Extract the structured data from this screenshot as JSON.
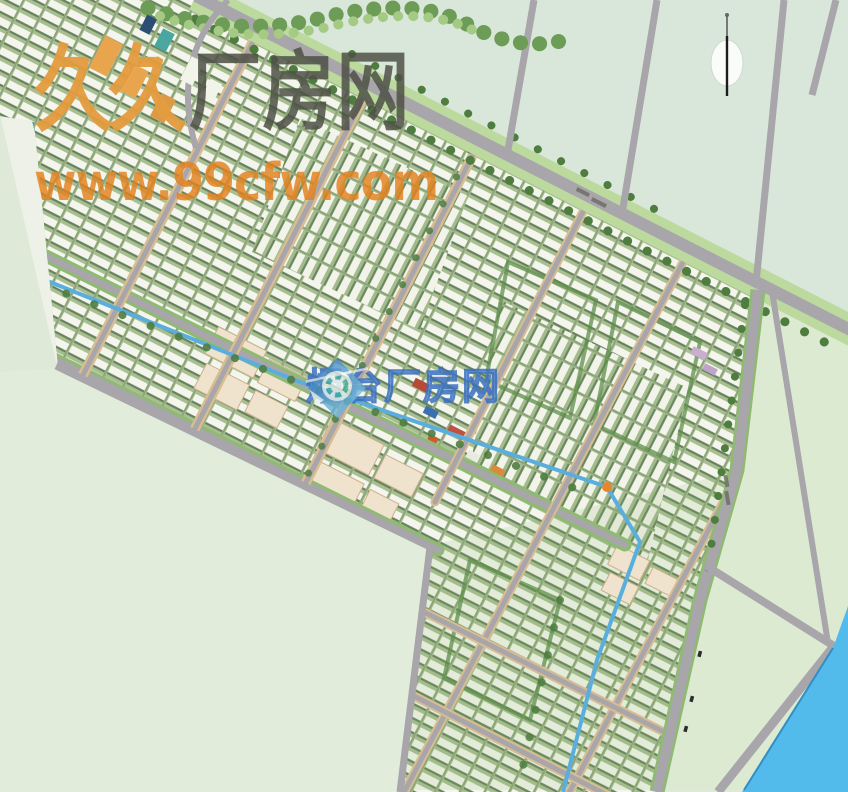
{
  "map": {
    "description": "aerial master plan rendering of an industrial park",
    "compass": {
      "icon": "north-compass-icon"
    }
  },
  "watermarks": {
    "primary": {
      "brand_cn_prefix": "久久",
      "brand_cn_suffix": "厂房网",
      "url": "www.99cfw.com",
      "prefix_color": "#e49b3e",
      "suffix_color": "#4e5146",
      "url_color": "#e4821e"
    },
    "secondary": {
      "brand_cn": "烟台厂房网",
      "color": "#3a6fc0",
      "logo": "diamond-aperture-logo-icon"
    }
  },
  "colors": {
    "land": "#dfe9d8",
    "empty_parcel": "#d9e7da",
    "road": "#a8a5ab",
    "water": "#53bbec",
    "canal": "#5aaede",
    "vegetation": "#4e7d3f",
    "building_white": "#f3f5ec",
    "building_beige": "#efe3cd",
    "accent_orange": "#e8872a"
  }
}
